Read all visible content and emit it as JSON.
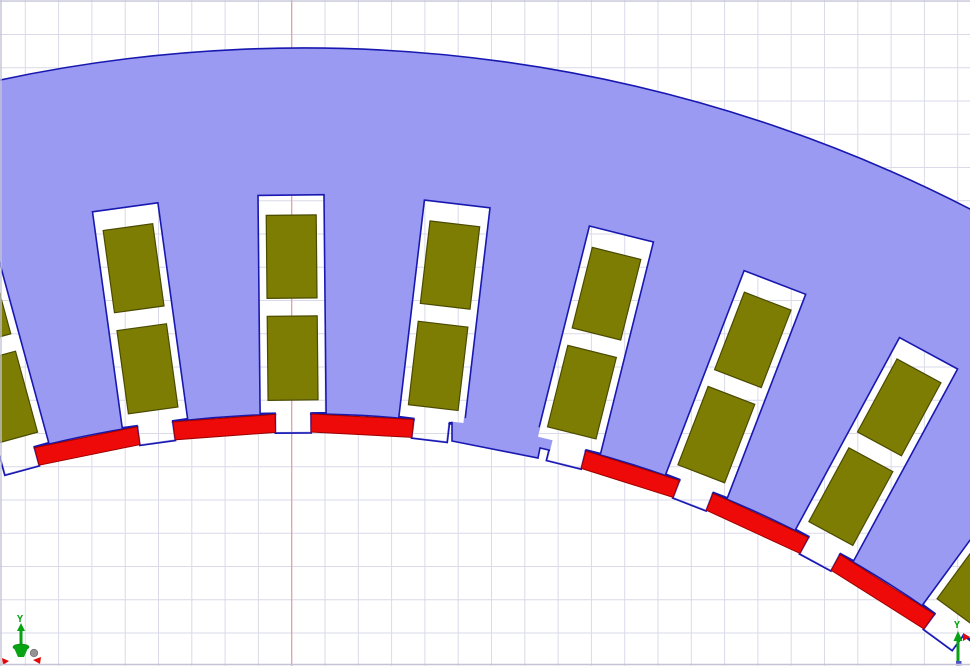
{
  "viewport": {
    "width": 970,
    "height": 666,
    "background": "#ffffff",
    "border_color": "#c4c4d6"
  },
  "grid": {
    "x0": 25.3,
    "y0": 1.3,
    "spacing_x": 33.3,
    "spacing_y": 33.25,
    "cols": 29,
    "rows": 20,
    "line_color": "#dadae9",
    "axis_line_color": "#e39b9b",
    "axis_line_x": 291.7
  },
  "machine": {
    "center": {
      "x": 304,
      "y": 1506
    },
    "stator": {
      "fill": "#9a9af2",
      "stroke": "#1818b0",
      "stroke_width": 1.6,
      "outer_radius": 1458,
      "inner_radius": 1092,
      "outer_arc_deg": [
        -12.8,
        28.6
      ],
      "inner_arc_deg": [
        -17.0,
        39.6
      ]
    },
    "slots": {
      "angles_deg": [
        -15.23,
        -7.84,
        -0.57,
        6.71,
        14.01,
        21.05,
        28.45,
        36.2
      ],
      "top_radius": 1311,
      "half_width": 33,
      "depth": 218,
      "neck_half_width": 18,
      "neck_depth": 238,
      "clip_inset": 1.2
    },
    "coils": {
      "fill": "#7d7d04",
      "stroke": "#4a4a00",
      "stroke_width": 1.2,
      "half_width": 25,
      "upper_span": [
        20,
        103
      ],
      "lower_span": [
        121,
        205
      ]
    },
    "wedges": {
      "fill": "#ef0a0a",
      "stroke": "#9c0000",
      "stroke_width": 1,
      "outer_radius": 1092,
      "inner_radius": 1074,
      "edge_clearance_deg": 0.95,
      "between_slots": [
        [
          0,
          1
        ],
        [
          1,
          2
        ],
        [
          2,
          3
        ],
        [
          4,
          5
        ],
        [
          5,
          6
        ],
        [
          6,
          7
        ]
      ]
    },
    "tooth_tip": {
      "fill_points": [
        [
          452,
          420
        ],
        [
          452,
          441
        ],
        [
          538,
          458
        ],
        [
          540,
          448
        ],
        [
          553,
          451
        ],
        [
          553,
          429
        ],
        [
          466,
          418
        ]
      ],
      "outline_points": [
        [
          452,
          418
        ],
        [
          452,
          441
        ],
        [
          538,
          458
        ],
        [
          540,
          448
        ],
        [
          553,
          451
        ],
        [
          555,
          437
        ]
      ]
    }
  },
  "axis_triads": {
    "y_label": "Y",
    "green": "#07a312",
    "green_dark": "#057a0d",
    "red": "#e00808",
    "gray": "#949494",
    "blue": "#5050c8",
    "origin_triad": {
      "x": 21,
      "y": 646
    },
    "corner_triad": {
      "x": 958,
      "y": 650
    }
  }
}
